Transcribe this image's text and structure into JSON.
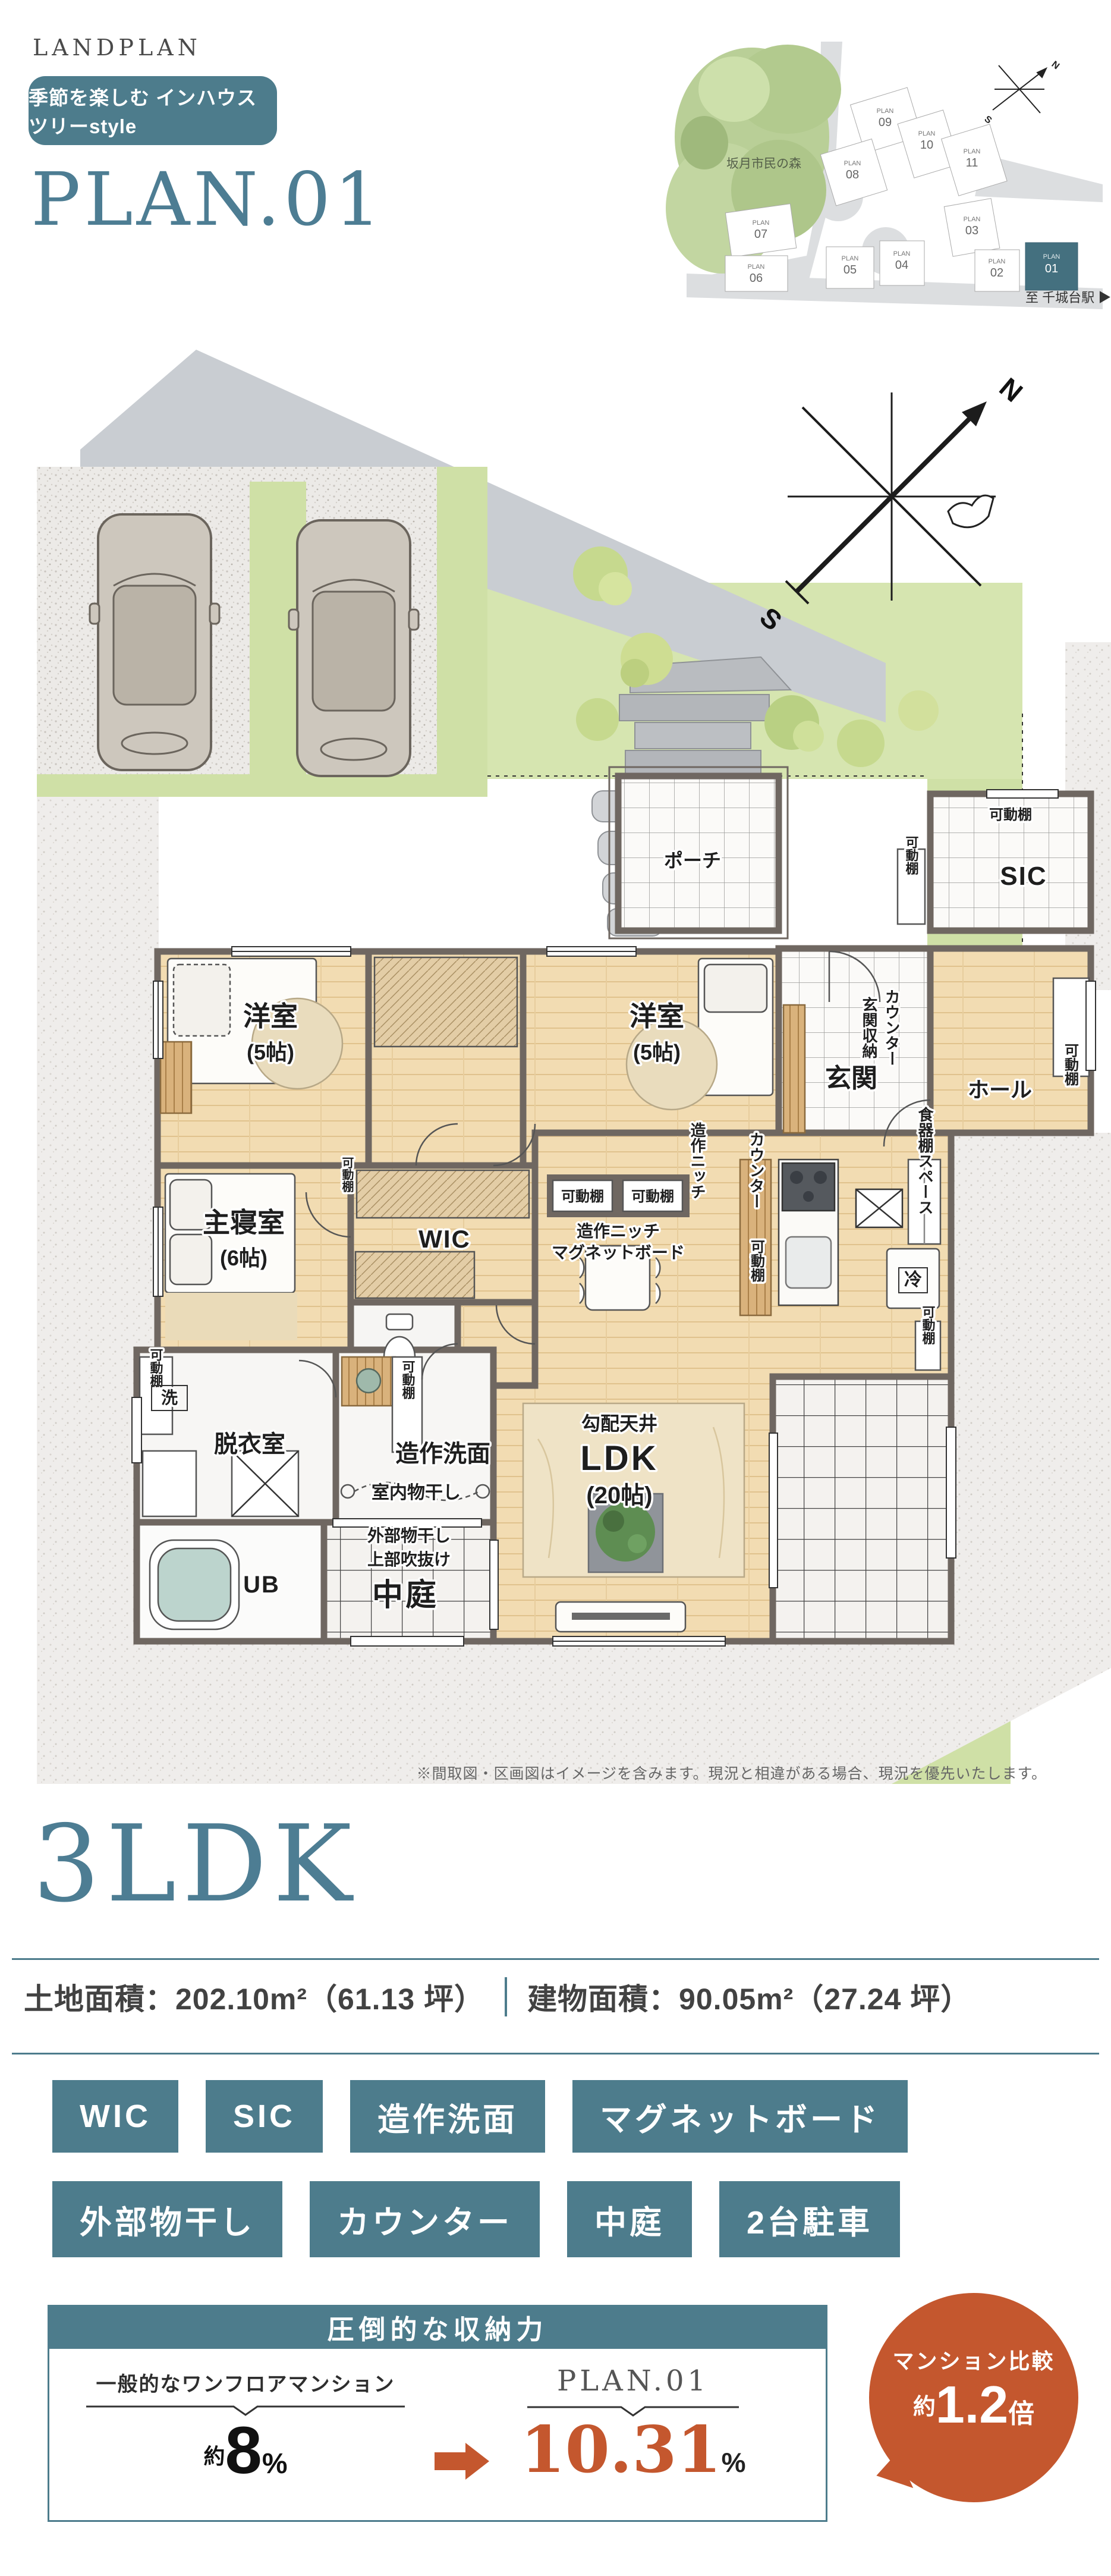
{
  "colors": {
    "teal": "#4d7c8c",
    "orange": "#c4572e",
    "serif_teal": "#4d7d93",
    "wall": "#6f6761",
    "wood": "#f2dcb2",
    "lawn": "#cfe0a6"
  },
  "header": {
    "badge_label": "季節を楽しむ インハウスツリーstyle",
    "plan_title": "PLAN.01"
  },
  "landplan": {
    "title": "LANDPLAN",
    "forest_label": "坂月市民の森",
    "station_label": "至 千城台駅",
    "station_arrow": "▶",
    "lot_word": "PLAN",
    "north_label": "N",
    "south_label": "S",
    "lots": [
      {
        "num": "01"
      },
      {
        "num": "02"
      },
      {
        "num": "03"
      },
      {
        "num": "04"
      },
      {
        "num": "05"
      },
      {
        "num": "06"
      },
      {
        "num": "07"
      },
      {
        "num": "08"
      },
      {
        "num": "09"
      },
      {
        "num": "10"
      },
      {
        "num": "11"
      }
    ]
  },
  "floorplan": {
    "compass": {
      "n": "N",
      "s": "S"
    },
    "labels": {
      "porch": "ポーチ",
      "sic": "SIC",
      "genkan": "玄関",
      "hall": "ホール",
      "genkan_shuno": "玄関収納",
      "counter": "カウンター",
      "yoshitsu": "洋室",
      "yoshitsu_size": "(5帖)",
      "shushin": "主寝室",
      "shushin_size": "(6帖)",
      "wic": "WIC",
      "kobai": "勾配天井",
      "ldk": "LDK",
      "ldk_size": "(20帖)",
      "kado": "可動棚",
      "zosaku_niche": "造作ニッチ",
      "magnet": "マグネットボード",
      "shokki": "食器棚スペース",
      "rei": "冷",
      "datsui": "脱衣室",
      "zosaku_senmen": "造作洗面",
      "shitsunai": "室内物干し",
      "sen": "洗",
      "ub": "UB",
      "gaibu": "外部物干し",
      "jobu": "上部吹抜け",
      "nakaniwa": "中庭"
    }
  },
  "disclaimer": "※間取図・区画図はイメージを含みます。現況と相違がある場合、現況を優先いたします。",
  "summary": {
    "layout_title": "3LDK",
    "land_label": "土地面積：202.10m²（61.13 坪）",
    "building_label": "建物面積：90.05m²（27.24 坪）"
  },
  "features": [
    "WIC",
    "SIC",
    "造作洗面",
    "マグネットボード",
    "外部物干し",
    "カウンター",
    "中庭",
    "2台駐車"
  ],
  "storage": {
    "header": "圧倒的な収納力",
    "left_label": "一般的なワンフロアマンション",
    "left_approx": "約",
    "left_value": "8",
    "left_unit": "%",
    "right_label": "PLAN.01",
    "right_value": "10.31",
    "right_unit": "%",
    "bubble_line1": "マンション比較",
    "bubble_approx": "約",
    "bubble_value": "1.2",
    "bubble_suffix": "倍"
  }
}
